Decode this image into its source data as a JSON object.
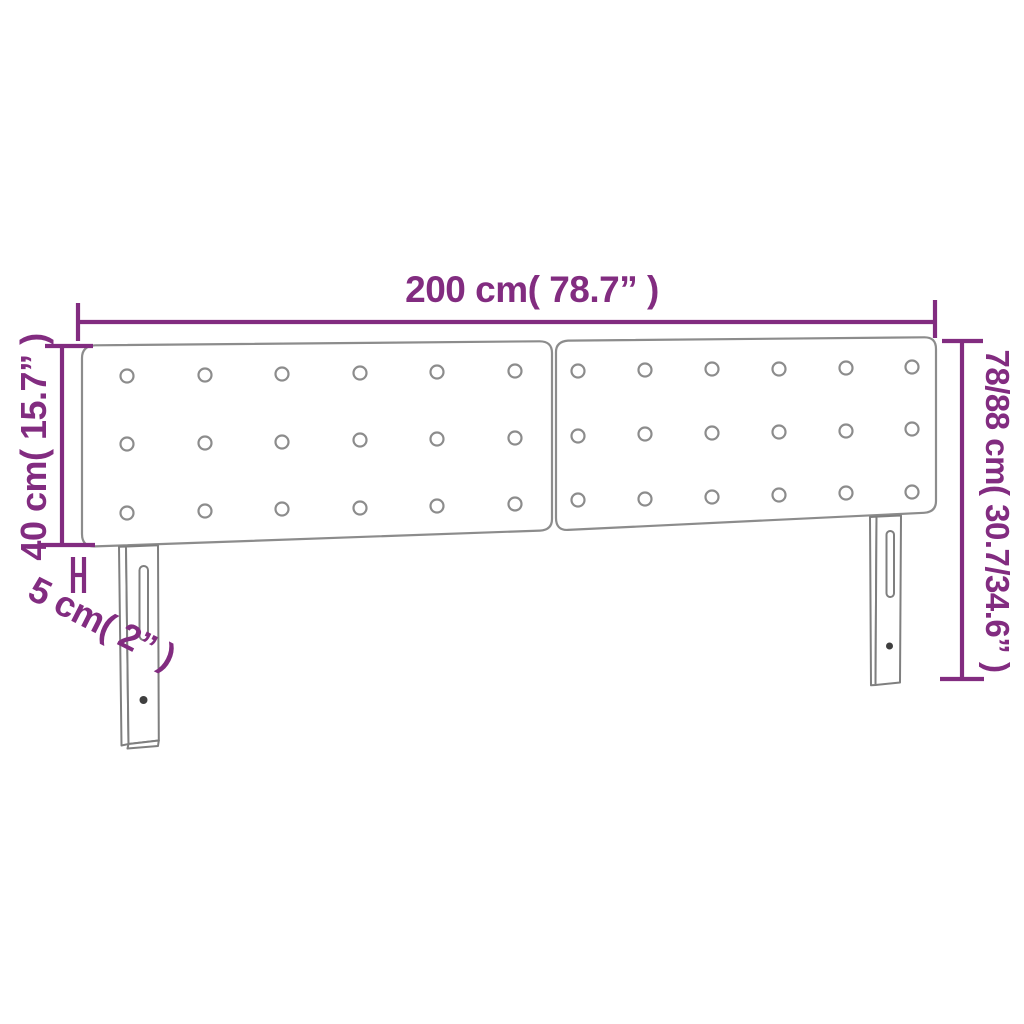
{
  "diagram": {
    "title": "headboard-dimension-diagram",
    "dimensions": {
      "width_label": "200 cm( 78.7” )",
      "total_height_label": "78/88 cm( 30.7/34.6” )",
      "panel_height_label": "40 cm( 15.7” )",
      "thickness_label": "5 cm( 2” )"
    },
    "colors": {
      "dimension_line": "#822c80",
      "product_outline": "#8c8c8c",
      "screw_dot": "#3f3f3f",
      "background": "#ffffff"
    },
    "product": {
      "panels": 2,
      "button_rows": 3,
      "buttons_per_panel_row": 6,
      "legs": 2,
      "slots_per_leg": 1,
      "screw_holes_per_leg": 1
    }
  }
}
